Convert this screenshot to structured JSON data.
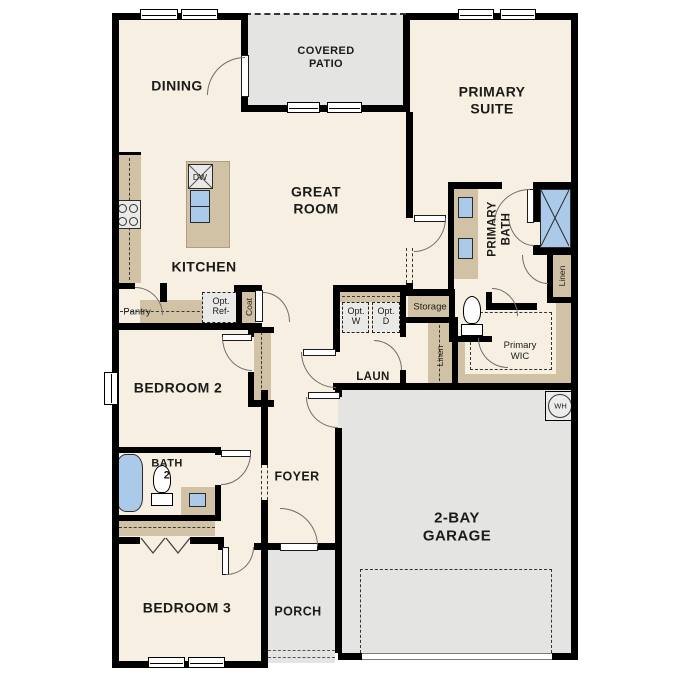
{
  "rooms": {
    "dining": "DINING",
    "covered_patio": "COVERED\nPATIO",
    "primary_suite": "PRIMARY\nSUITE",
    "great_room": "GREAT\nROOM",
    "kitchen": "KITCHEN",
    "bedroom2": "BEDROOM 2",
    "bath2": "BATH\n2",
    "foyer": "FOYER",
    "laundry": "LAUN",
    "primary_bath": "PRIMARY\nBATH",
    "primary_wic": "Primary\nWIC",
    "garage": "2-BAY\nGARAGE",
    "bedroom3": "BEDROOM 3",
    "porch": "PORCH"
  },
  "features": {
    "pantry": "Pantry",
    "opt_ref": "Opt.\nRef-",
    "coat": "Coat",
    "dishwasher": "DW",
    "opt_washer": "Opt.\nW",
    "opt_dryer": "Opt.\nD",
    "storage": "Storage",
    "linen_hall": "Linen",
    "linen_primary": "Linen",
    "water_heater": "WH"
  },
  "colors": {
    "wall": "#000000",
    "floor": "#f7efe1",
    "cabinet": "#d1c2a5",
    "concrete": "#e4e4e2",
    "appliance": "#e9e9e7",
    "fixture": "#abc9e9"
  }
}
